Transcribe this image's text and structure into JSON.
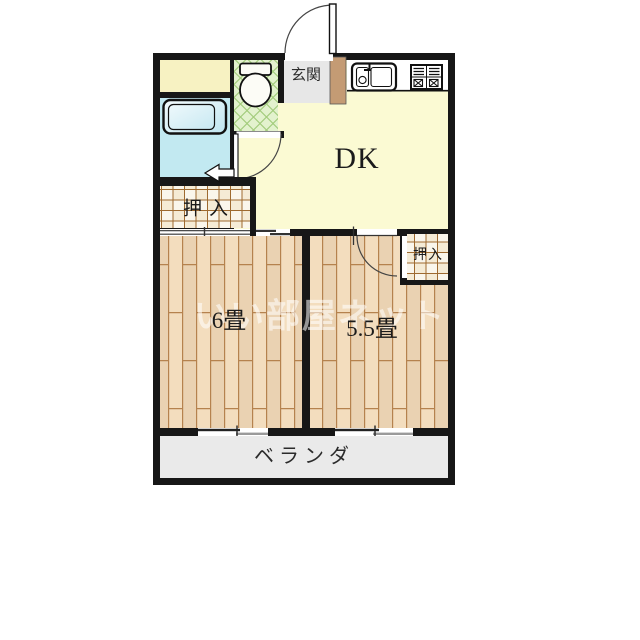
{
  "plan": {
    "labels": {
      "dk": "DK",
      "genkan": "玄関",
      "room6": "6畳",
      "room55": "5.5畳",
      "oshiire_left": "押入",
      "oshiire_right": "押入",
      "veranda": "ベランダ"
    },
    "watermark": "いい部屋ネット",
    "colors": {
      "wall": "#171717",
      "dk_floor": "#FBFAD3",
      "utility_floor": "#F7F2C2",
      "bath_floor": "#C2E9F1",
      "toilet_floor": "#E3F2CE",
      "genkan_floor": "#E7E7E7",
      "step": "#C49B74",
      "wood_floor": "#F3DDBE",
      "closet_bg": "#F5EBD5",
      "veranda_floor": "#EAEAEA",
      "fixture_fill": "#FCFCF6"
    }
  }
}
